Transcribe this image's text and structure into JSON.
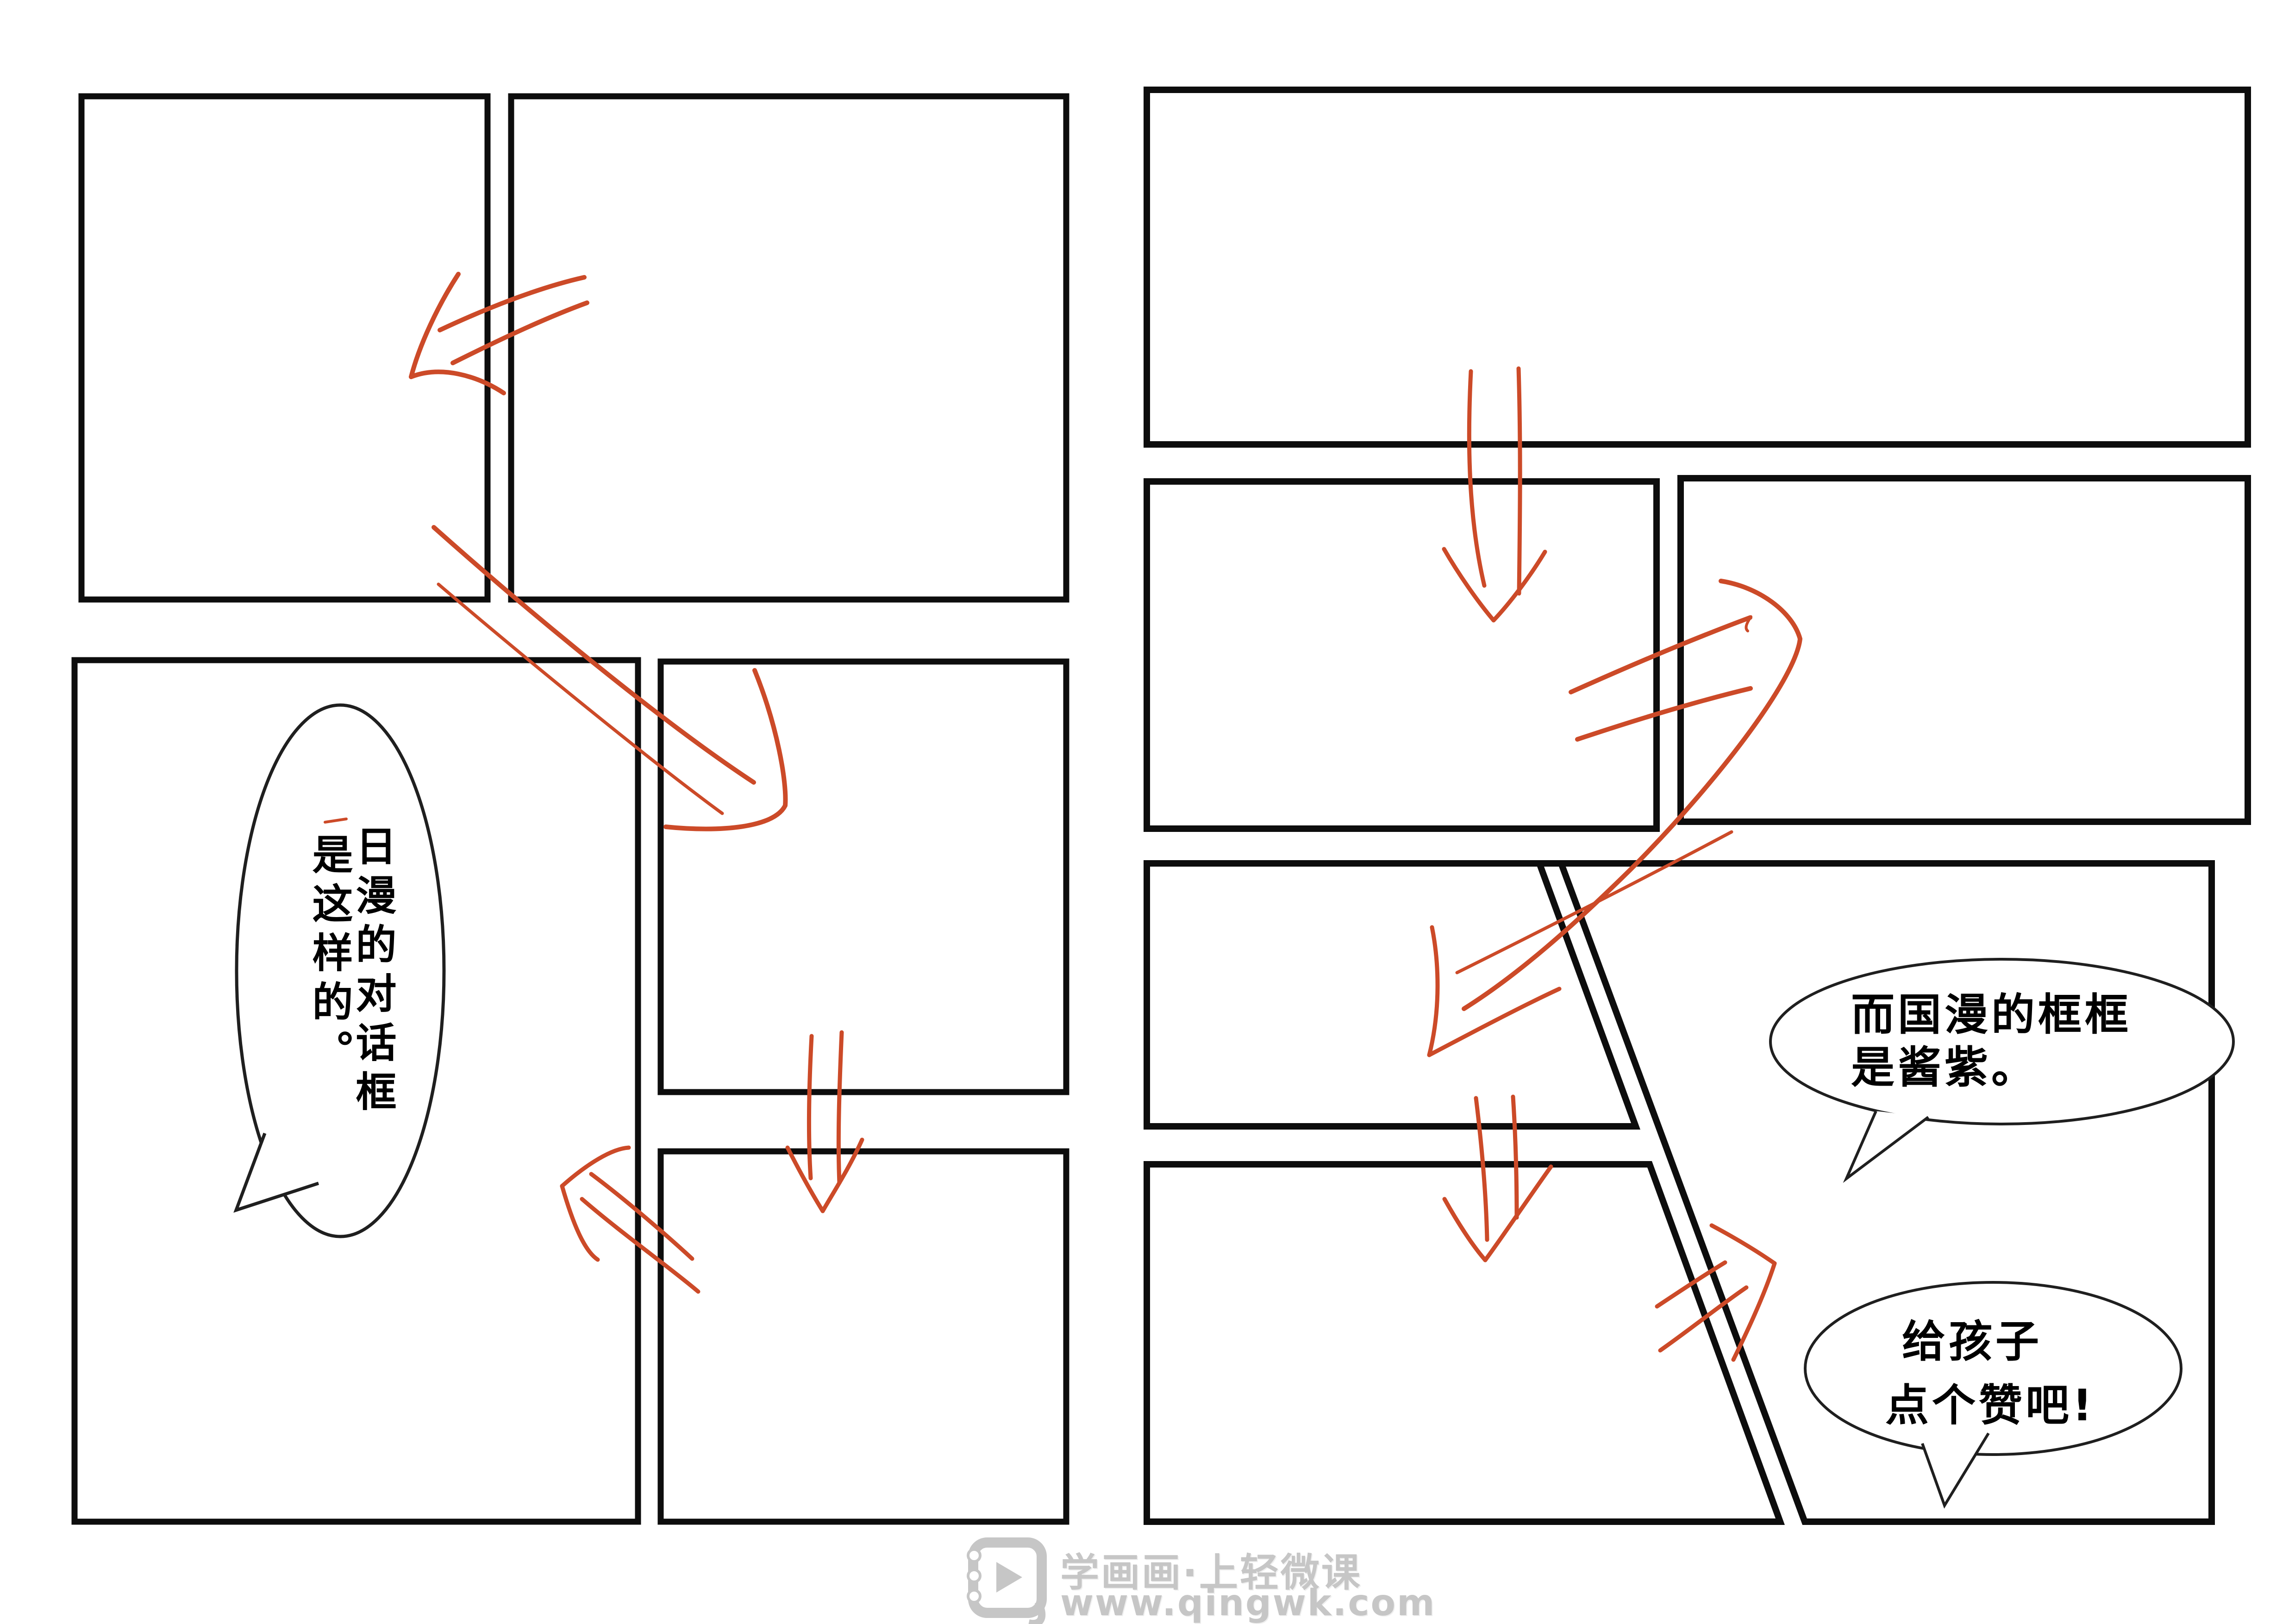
{
  "colors": {
    "background": "#ffffff",
    "panel_border": "#0d0d0d",
    "arrow_accent": "#cc4a28",
    "bubble_border": "#1f1f1f",
    "text": "#000000",
    "watermark_gray": "#c6c6c6"
  },
  "left_page": {
    "bubble_vertical": {
      "col_right": "日漫的对话框",
      "col_left": "是这样的。"
    }
  },
  "right_page": {
    "bubble_frames": {
      "line1": "而国漫的框框",
      "line2": "是酱紫。"
    },
    "bubble_like": {
      "line1": "给孩子",
      "line2": "点个赞吧!"
    }
  },
  "watermark": {
    "brand": "学画画·上轻微课",
    "url": "www.qingwk.com",
    "icon": "qingwk-play-logo"
  }
}
